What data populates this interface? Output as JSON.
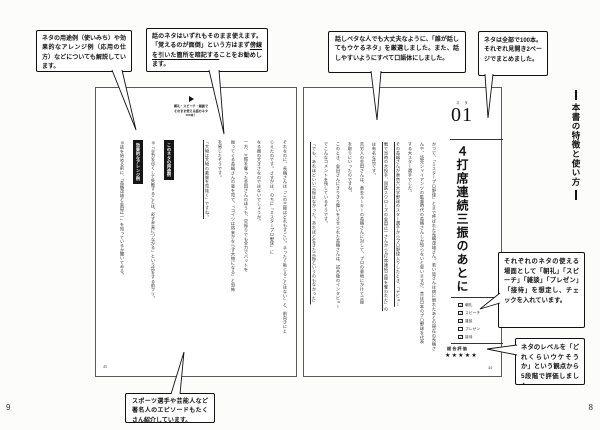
{
  "page": {
    "corner_left": "9",
    "corner_right": "8",
    "header": "本書の特徴と使い方"
  },
  "callouts": {
    "usage": "ネタの用途例（使いみち）や効果的なアレンジ例（応用の仕方）などについても解説しています。",
    "memorize_pre": "話のネタはいずれもそのまま使えます。「覚えるのが面倒」という方はまず",
    "memorize_u": "傍線を引いた箇所を暗記する",
    "memorize_post": "ことをお勧めします。",
    "colloquial": "話しベタな人でも大丈夫なように、「誰が話してもウケるネタ」を厳選しました。また、話しやすいようにすべて口語体にしました。",
    "hundred": "ネタは全部で100本。それぞれ見開き2ページでまとめました。",
    "scenes": "それぞれのネタの使える場面として「朝礼」「スピーチ」「雑談」「プレゼン」「接待」を想定し、チェックを入れています。",
    "rating": "ネタのレベルを「どれくらいウケそうか」という観点から5段階で評価しました。",
    "episodes": "スポーツ選手や芸能人など著名人のエピソードもたくさん紹介しています。"
  },
  "left_page": {
    "logo": {
      "line1": "朝礼・スピーチ・雑談で",
      "line2": "そのまま使える話のネタ",
      "line3": "100本！"
    },
    "columns": [
      "それなのに、長嶋さんは「この三振はどれもすごい。まったく恥じることはない」と、前向きにと",
      "らえたのです。さすがは、のちに「ミスタープロ野球」に",
      "なる器の大きさなのではないでしょうか。",
      "一方、三振を奪った金田さんのほうも、空振りでも全力でバットを",
      "振ってくる長嶋さんの姿を見て、「コイツは将来かならず大物になる」と恐怖",
      "を感じたそうです。",
      "「大物は大物の素質を見抜く」ですね。"
    ],
    "sections": [
      {
        "heading": "このネタの用途例",
        "body": "◎「全力を尽くして失敗することは、必ず未来につながる」という話をする前フリ。"
      },
      {
        "heading": "効果的なアレンジ例",
        "body": "◎話を始める前に、「長嶋茂雄と金田正一」を知っているか聞いてみる。"
      }
    ],
    "page_number": "45"
  },
  "right_page": {
    "neta_label": "ネタ",
    "neta_number": "01",
    "title": "４打席連続三振のあとに",
    "columns": [
      "かつて、「ミスタープロ野球」とまで呼ばれた長嶋茂雄さん。若い皆さんは病に倒れたあとの現在の長嶋さ",
      "んや、読売ジャイアンツの監督時代の長嶋さんしか知らないと思いますが、昔は日本のプロ野球を代表",
      "する大スター選手でした。",
      "その長嶋さんが東京六大学野球のスター選手からプロ野球入りしたとき、「デビュー",
      "戦で当時の大投手、国鉄スワローズの金田正一さんから4打席連続三振を奪われた」の",
      "は有名な話です。",
      "苦労人の金田さんは、黄金ルーキーの長嶋さんに対して、プロの意地にかけて三振",
      "を取りにいったのですね。",
      "このとき、金田さんにきりきり舞いをさせられた長嶋さんは、試合後のインタビュー",
      "でこんなコメントを残しているそうです。",
      "「でも、あれほどいい三振はなかった。あれほど生きた三振というのもなかった」"
    ],
    "checklist": [
      {
        "label": "朝礼",
        "mark": "✓"
      },
      {
        "label": "スピーチ",
        "mark": "✓"
      },
      {
        "label": "雑談",
        "mark": "✓"
      },
      {
        "label": "プレゼン",
        "mark": ""
      },
      {
        "label": "接待",
        "mark": "✓"
      }
    ],
    "rating_label": "総合評価",
    "stars": "★★★★★",
    "page_number": "44"
  }
}
